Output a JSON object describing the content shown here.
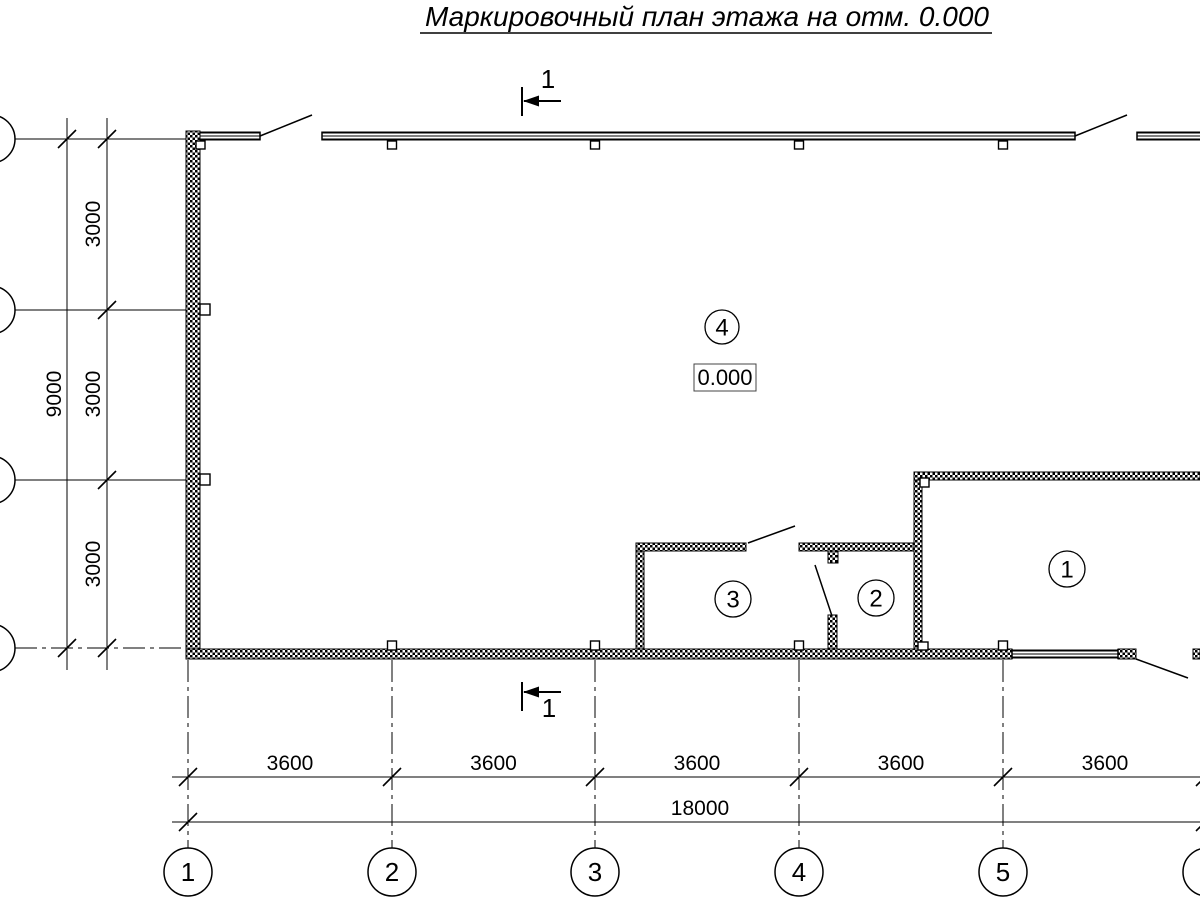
{
  "title": "Маркировочный план этажа на отм. 0.000",
  "section_mark": {
    "label": "1"
  },
  "elevation_box": {
    "value": "0.000"
  },
  "room_labels": {
    "hall": "4",
    "room1": "1",
    "room2": "2",
    "room3": "3"
  },
  "axis_columns": [
    "1",
    "2",
    "3",
    "4",
    "5",
    "6"
  ],
  "dims_bottom": {
    "bays": [
      "3600",
      "3600",
      "3600",
      "3600",
      "3600"
    ],
    "total": "18000"
  },
  "dims_left": {
    "bays": [
      "3000",
      "3000",
      "3000"
    ],
    "total": "9000"
  }
}
